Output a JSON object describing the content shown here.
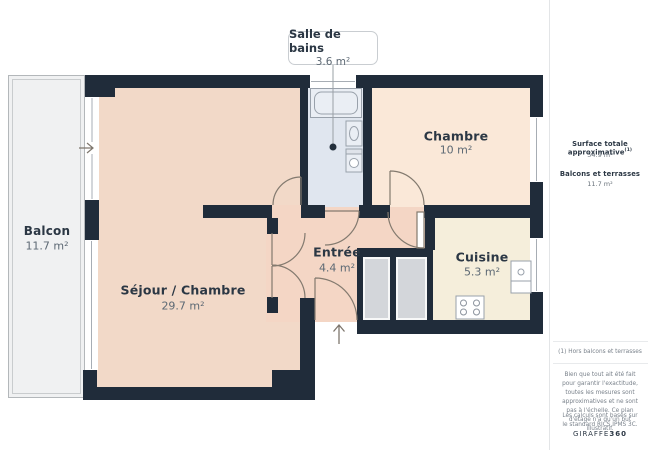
{
  "plan": {
    "callout": {
      "title": "Salle de bains",
      "area": "3.6 m²"
    },
    "rooms": [
      {
        "name": "Balcon",
        "area": "11.7 m²"
      },
      {
        "name": "Séjour / Chambre",
        "area": "29.7 m²"
      },
      {
        "name": "Chambre",
        "area": "10 m²"
      },
      {
        "name": "Entrée",
        "area": "4.4 m²"
      },
      {
        "name": "Cuisine",
        "area": "5.3 m²"
      }
    ],
    "colors": {
      "wall": "#202c3a",
      "sejour_floor": "#f2d9c8",
      "entree_floor": "#f4d6c5",
      "chambre_floor": "#fae8d8",
      "cuisine_floor": "#f5eedb",
      "bathroom_floor": "#e0e6ef",
      "balcony_floor": "#f0f1f2",
      "closet": "#d3d6da"
    }
  },
  "sidebar": {
    "surface_label": "Surface totale approximative",
    "surface_sup": "(1)",
    "surface_value": "54.9 m²",
    "balconies_label": "Balcons et terrasses",
    "balconies_value": "11.7 m²",
    "footnote": "(1) Hors balcons et terrasses",
    "disclaimer": "Bien que tout ait été fait pour garantir l'exactitude, toutes les mesures sont approximatives et ne sont pas à l'échelle. Ce plan d'étage n'a qu'un but illustratif.",
    "standard": "Les calculs sont basés sur le standard RICS IPMS 3C.",
    "logo_text": "GIRAFFE",
    "logo_suffix": "360"
  }
}
